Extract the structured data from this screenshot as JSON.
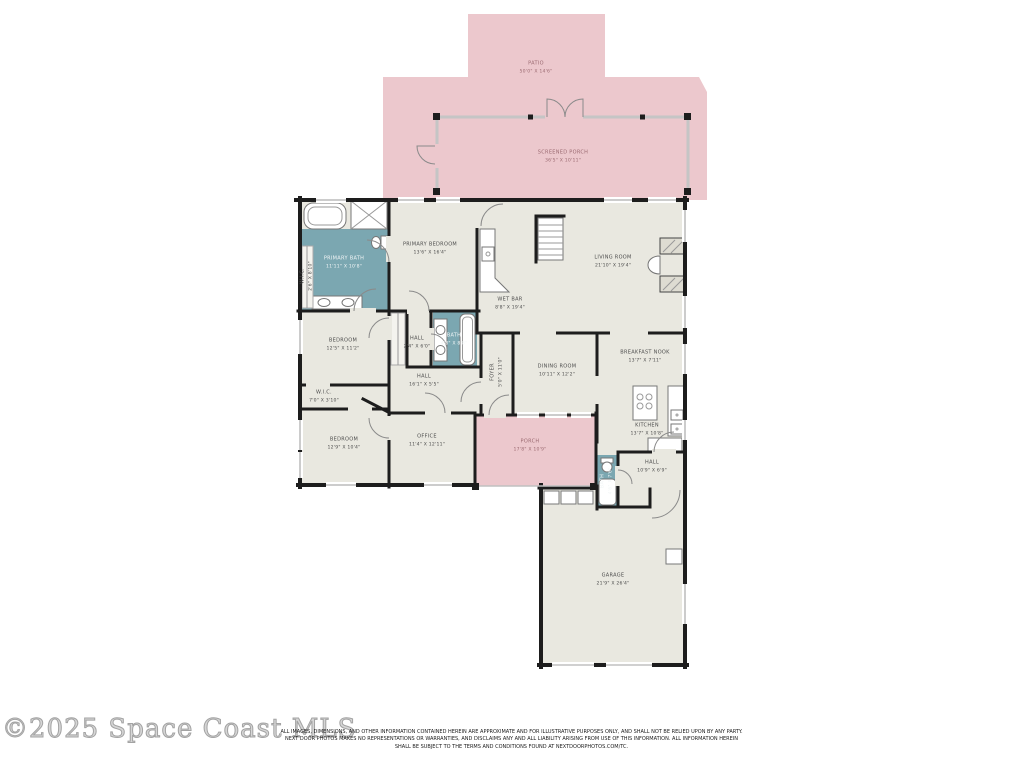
{
  "colors": {
    "patio_pink": "#ecc8cd",
    "floor_beige": "#e9e8e0",
    "bath_teal": "#7ba7b1",
    "wall_black": "#1d1d1d"
  },
  "rooms": {
    "patio": {
      "name": "PATIO",
      "dims": "50'0\" X 14'6\""
    },
    "screened_porch": {
      "name": "SCREENED PORCH",
      "dims": "36'5\" X 10'11\""
    },
    "primary_bath": {
      "name": "PRIMARY BATH",
      "dims": "11'11\" X 10'8\""
    },
    "wic_primary": {
      "name": "W.I.C.",
      "dims": "2'6\" X 8'10\""
    },
    "primary_bedroom": {
      "name": "PRIMARY BEDROOM",
      "dims": "13'6\" X 16'4\""
    },
    "living_room": {
      "name": "LIVING ROOM",
      "dims": "21'10\" X 19'4\""
    },
    "wet_bar": {
      "name": "WET BAR",
      "dims": "8'8\" X 19'4\""
    },
    "bedroom_mid": {
      "name": "BEDROOM",
      "dims": "12'5\" X 11'2\""
    },
    "hall_small": {
      "name": "HALL",
      "dims": "2'4\" X 6'0\""
    },
    "bath_hall": {
      "name": "BATH",
      "dims": "4'8\" X 8'8\""
    },
    "hall_main": {
      "name": "HALL",
      "dims": "16'1\" X 5'5\""
    },
    "foyer": {
      "name": "FOYER",
      "dims": "5'0\" X 11'0\""
    },
    "dining_room": {
      "name": "DINING ROOM",
      "dims": "10'11\" X 12'2\""
    },
    "breakfast_nook": {
      "name": "BREAKFAST NOOK",
      "dims": "13'7\" X 7'11\""
    },
    "wic_hall": {
      "name": "W.I.C.",
      "dims": "7'0\" X 3'10\""
    },
    "bedroom_front": {
      "name": "BEDROOM",
      "dims": "12'9\" X 10'4\""
    },
    "office": {
      "name": "OFFICE",
      "dims": "11'4\" X 12'11\""
    },
    "porch": {
      "name": "PORCH",
      "dims": "17'8\" X 10'9\""
    },
    "kitchen": {
      "name": "KITCHEN",
      "dims": "13'7\" X 10'8\""
    },
    "hall_garage": {
      "name": "HALL",
      "dims": "10'9\" X 6'9\""
    },
    "bath_garage": {
      "name": "BATH",
      "dims": "4'6\" X 7'6\""
    },
    "garage": {
      "name": "GARAGE",
      "dims": "21'9\" X 26'4\""
    }
  },
  "watermark": "©2025 Space Coast MLS",
  "disclaimer": {
    "line1": "ALL IMAGES, DIMENSIONS, AND OTHER INFORMATION CONTAINED HEREIN ARE APPROXIMATE AND FOR ILLUSTRATIVE PURPOSES ONLY, AND SHALL NOT BE RELIED UPON BY ANY PARTY.",
    "line2": "NEXT DOOR PHOTOS MAKES NO REPRESENTATIONS OR WARRANTIES, AND DISCLAIMS ANY AND ALL LIABILITY ARISING FROM USE OF THIS INFORMATION. ALL INFORMATION HEREIN",
    "line3": "SHALL BE SUBJECT TO THE TERMS AND CONDITIONS FOUND AT NEXTDOORPHOTOS.COM/TC."
  }
}
